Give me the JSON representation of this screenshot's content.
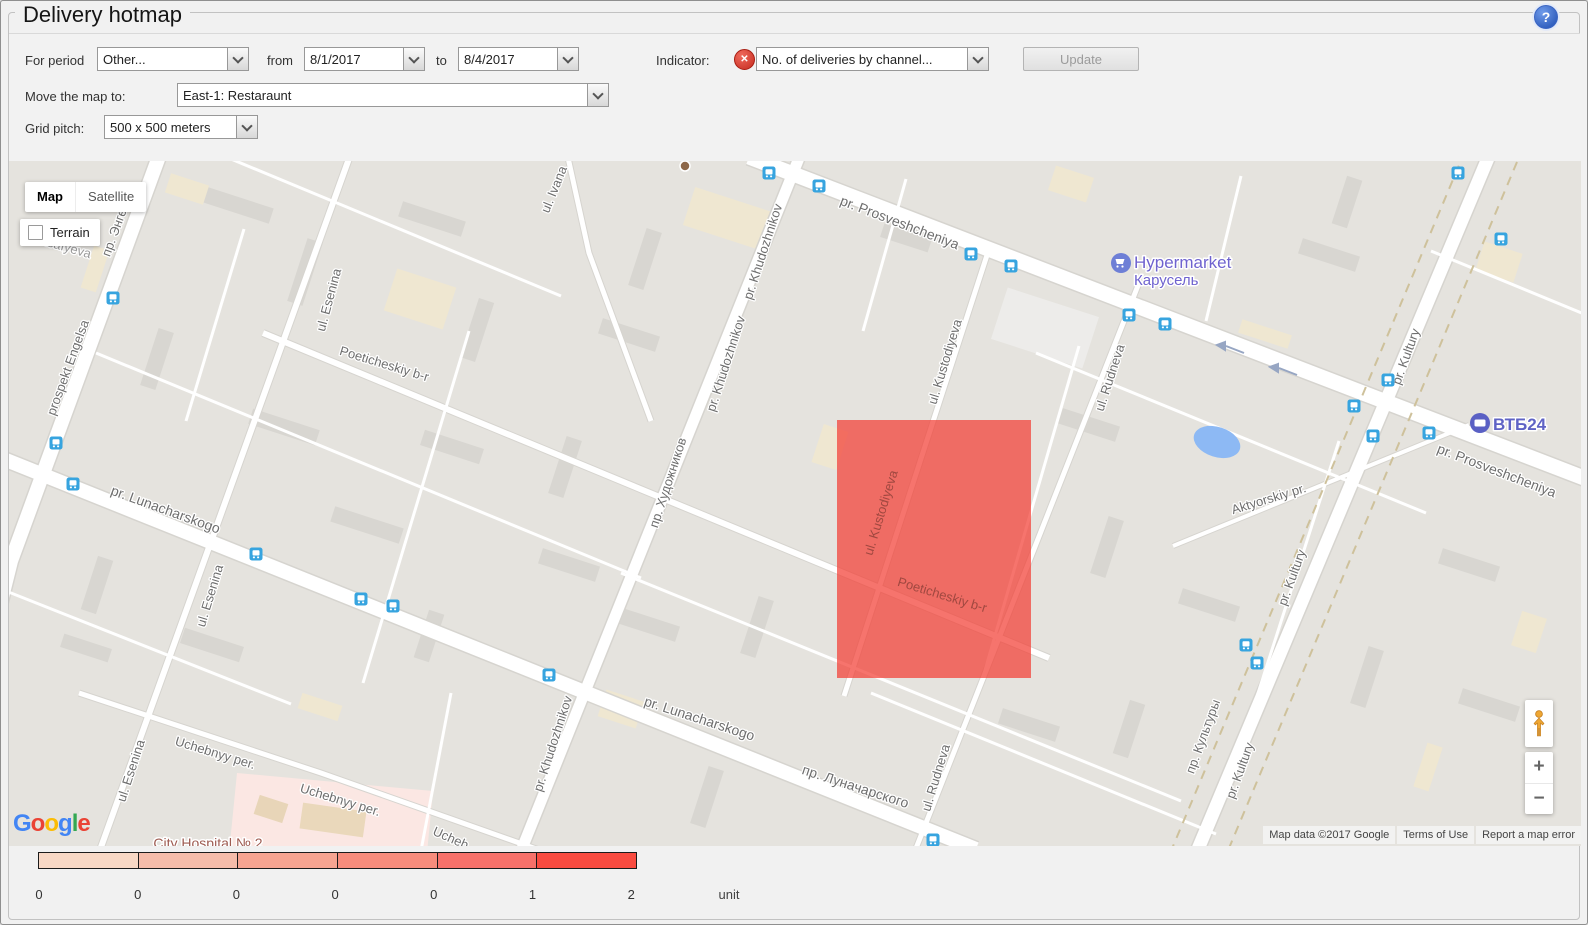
{
  "header": {
    "title": "Delivery hotmap",
    "help_glyph": "?"
  },
  "toolbar": {
    "for_period_label": "For period",
    "period_value": "Other...",
    "from_label": "from",
    "from_value": "8/1/2017",
    "to_label": "to",
    "to_value": "8/4/2017",
    "indicator_label": "Indicator:",
    "indicator_value": "No. of deliveries by channel...",
    "update_label": "Update",
    "move_map_label": "Move the map to:",
    "move_map_value": "East-1: Restaraunt",
    "grid_pitch_label": "Grid pitch:",
    "grid_pitch_value": "500 x 500 meters"
  },
  "map": {
    "type_controls": {
      "map": "Map",
      "satellite": "Satellite",
      "terrain": "Terrain"
    },
    "zoom_in": "+",
    "zoom_out": "−",
    "google_letters": [
      "G",
      "o",
      "o",
      "g",
      "l",
      "e"
    ],
    "attribution": {
      "map_data": "Map data ©2017 Google",
      "terms": "Terms of Use",
      "report": "Report a map error"
    },
    "poi": {
      "hypermarket": {
        "name": "Hypermarket",
        "subtitle": "Карусель"
      },
      "bank": {
        "name": "ВТБ24"
      },
      "hospital": {
        "name": "City Hospital № 2"
      }
    },
    "overlay": {
      "x": 836,
      "y": 419,
      "width": 194,
      "height": 258,
      "color": "rgba(242,62,53,0.72)"
    },
    "street_labels": [
      {
        "text": "пр. Энгельса",
        "x": 122,
        "y": 220,
        "rot": -70
      },
      {
        "text": "Asafyeva",
        "x": 63,
        "y": 250,
        "rot": 16,
        "color": "#9b9b9b"
      },
      {
        "text": "prospekt Engelsa",
        "x": 71,
        "y": 368,
        "rot": -70
      },
      {
        "text": "ul. Ivana",
        "x": 557,
        "y": 190,
        "rot": -68
      },
      {
        "text": "ul. Esenina",
        "x": 332,
        "y": 300,
        "rot": -75
      },
      {
        "text": "Poeticheskiy b-r",
        "x": 382,
        "y": 367,
        "rot": 17
      },
      {
        "text": "pr. Khudozhnikov",
        "x": 766,
        "y": 252,
        "rot": -72
      },
      {
        "text": "pr. Khudozhnikov",
        "x": 729,
        "y": 364,
        "rot": -72
      },
      {
        "text": "пр. Художников",
        "x": 671,
        "y": 483,
        "rot": -72
      },
      {
        "text": "pr. Prosveshcheniya",
        "x": 897,
        "y": 226,
        "rot": 21,
        "size": 14
      },
      {
        "text": "ul. Kustodiyeva",
        "x": 948,
        "y": 362,
        "rot": -73
      },
      {
        "text": "ul. Rudneva",
        "x": 1113,
        "y": 378,
        "rot": -72
      },
      {
        "text": "pr. Kultury",
        "x": 1409,
        "y": 357,
        "rot": -70
      },
      {
        "text": "pr. Prosveshcheniya",
        "x": 1494,
        "y": 474,
        "rot": 21,
        "size": 14
      },
      {
        "text": "Aktyorskiy pr.",
        "x": 1269,
        "y": 502,
        "rot": -17
      },
      {
        "text": "pr. Lunacharskogo",
        "x": 163,
        "y": 513,
        "rot": 20,
        "size": 14
      },
      {
        "text": "ul. Esenina",
        "x": 213,
        "y": 596,
        "rot": -73
      },
      {
        "text": "ul. Kustodiyeva",
        "x": 884,
        "y": 513,
        "rot": -73,
        "color": "#a04840",
        "halo": "none"
      },
      {
        "text": "Poeticheskiy b-r",
        "x": 940,
        "y": 598,
        "rot": 17,
        "color": "#a04840",
        "halo": "none"
      },
      {
        "text": "pr. Kultury",
        "x": 1295,
        "y": 578,
        "rot": -70
      },
      {
        "text": "pr. Khudozhnikov",
        "x": 556,
        "y": 744,
        "rot": -72
      },
      {
        "text": "pr. Lunacharskogo",
        "x": 697,
        "y": 722,
        "rot": 18,
        "size": 14
      },
      {
        "text": "пр. Луначарского",
        "x": 853,
        "y": 790,
        "rot": 18,
        "size": 14
      },
      {
        "text": "ul. Rudneva",
        "x": 939,
        "y": 778,
        "rot": -73
      },
      {
        "text": "Uchebnyy per.",
        "x": 213,
        "y": 756,
        "rot": 17
      },
      {
        "text": "Uchebnyy per.",
        "x": 338,
        "y": 803,
        "rot": 17
      },
      {
        "text": "Ucheb",
        "x": 448,
        "y": 841,
        "rot": 24
      },
      {
        "text": "ul. Esenina",
        "x": 134,
        "y": 771,
        "rot": -72
      },
      {
        "text": "пр. Культуры",
        "x": 1206,
        "y": 737,
        "rot": -70
      },
      {
        "text": "pr. Kultury",
        "x": 1243,
        "y": 771,
        "rot": -70
      }
    ],
    "transit_stops": [
      [
        112,
        297
      ],
      [
        55,
        442
      ],
      [
        72,
        483
      ],
      [
        255,
        553
      ],
      [
        360,
        598
      ],
      [
        392,
        605
      ],
      [
        548,
        674
      ],
      [
        768,
        172
      ],
      [
        818,
        185
      ],
      [
        970,
        253
      ],
      [
        1010,
        265
      ],
      [
        1128,
        314
      ],
      [
        1164,
        323
      ],
      [
        1387,
        379
      ],
      [
        1353,
        405
      ],
      [
        1372,
        435
      ],
      [
        1428,
        432
      ],
      [
        1457,
        172
      ],
      [
        1500,
        238
      ],
      [
        1245,
        644
      ],
      [
        1256,
        662
      ],
      [
        932,
        839
      ]
    ]
  },
  "legend": {
    "colors": [
      "#f8d8c5",
      "#f5bcaa",
      "#f6a491",
      "#f78c7c",
      "#f7716a",
      "#f94b40"
    ],
    "ticks": [
      "0",
      "0",
      "0",
      "0",
      "0",
      "1",
      "2"
    ],
    "unit_label": "unit"
  }
}
